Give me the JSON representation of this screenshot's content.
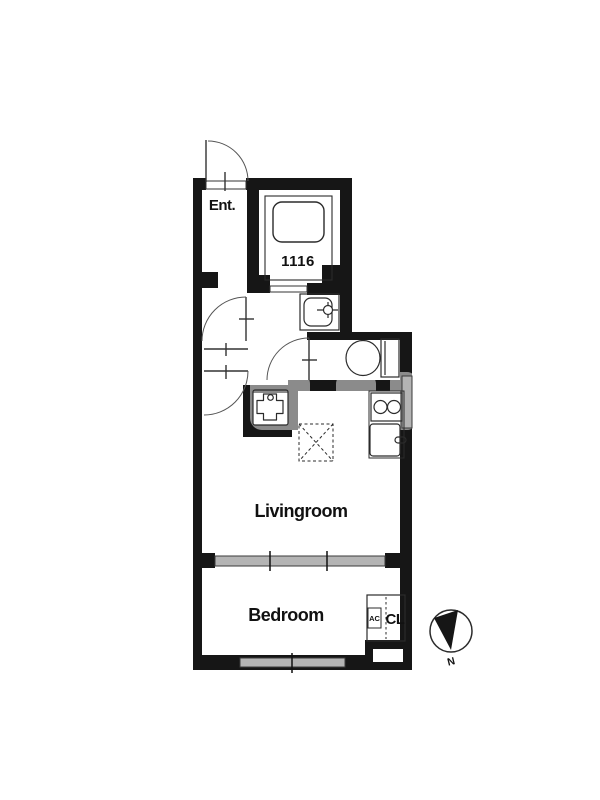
{
  "labels": {
    "entrance": "Ent.",
    "unit_bath_number": "1116",
    "livingroom": "Livingroom",
    "bedroom": "Bedroom",
    "air_conditioner": "AC",
    "closet": "CL",
    "compass_north": "N"
  },
  "colors": {
    "wall": "#161616",
    "line": "#2b2b2b",
    "window": "#b4b4b4",
    "text": "#111111",
    "background": "#ffffff"
  },
  "fixtures": [
    "entrance-door",
    "unit-bath",
    "bathtub",
    "washbasin",
    "toilet",
    "gas-stove",
    "kitchen-sink",
    "washing-machine-pan",
    "refrigerator-space",
    "sliding-partition",
    "bedroom-window",
    "closet",
    "air-conditioner",
    "north-compass"
  ]
}
